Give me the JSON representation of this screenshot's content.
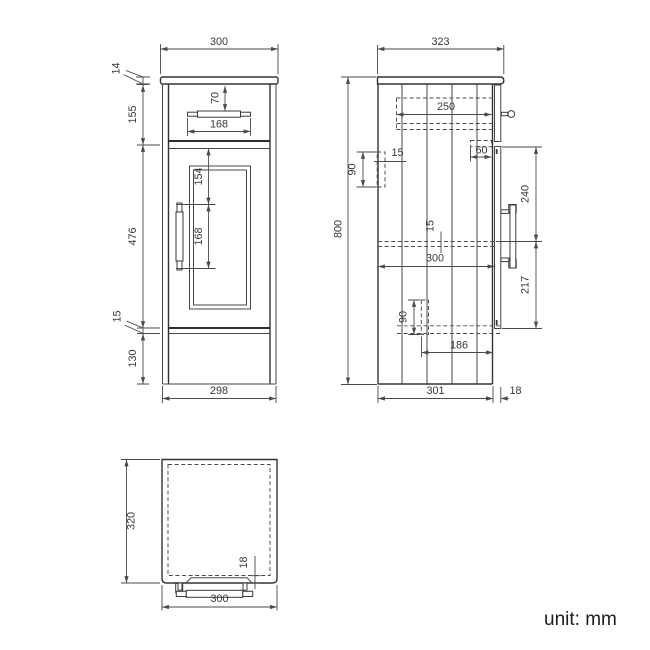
{
  "views": {
    "front": {
      "dims": {
        "overall_width": "300",
        "worktop_thickness": "14",
        "drawer_front_height": "155",
        "drawer_handle_offset": "70",
        "drawer_handle_width": "168",
        "door_height": "476",
        "door_handle_top_offset": "154",
        "door_handle_length": "168",
        "bottom_gap": "15",
        "plinth_height": "130",
        "carcass_width": "298"
      }
    },
    "side": {
      "dims": {
        "overall_depth": "323",
        "overall_height": "800",
        "drawer_depth": "250",
        "wall_rail_thickness": "15",
        "wall_rail_height": "90",
        "drawer_runner_depth": "60",
        "door_handle_top_offset": "240",
        "shelf_thickness": "15",
        "internal_depth": "300",
        "door_handle_bottom_offset": "217",
        "bottom_rail_height": "90",
        "plinth_setback": "186",
        "carcass_depth": "301",
        "door_thickness": "18"
      }
    },
    "top": {
      "dims": {
        "overall_depth": "320",
        "door_thickness": "18",
        "overall_width": "300"
      }
    }
  },
  "footer": {
    "unit_label": "unit: mm"
  }
}
